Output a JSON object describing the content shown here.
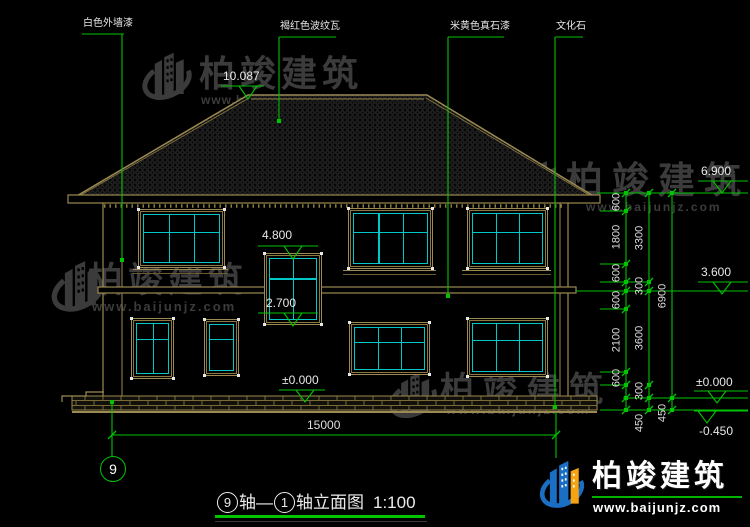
{
  "drawing_title": {
    "axis_start": "9",
    "mid": "轴—",
    "axis_end": "1",
    "suffix": "轴立面图",
    "scale": "1:100"
  },
  "axis_bubble_label": "9",
  "material_labels": [
    {
      "text": "白色外墙漆",
      "tx": 83,
      "ty": 19,
      "ux1": 82,
      "ux2": 124,
      "uy": 34,
      "lx": 122,
      "ly": 260
    },
    {
      "text": "褐红色波纹瓦",
      "tx": 280,
      "ty": 22,
      "ux1": 279,
      "ux2": 336,
      "uy": 37,
      "lx": 279,
      "ly": 121
    },
    {
      "text": "米黄色真石漆",
      "tx": 450,
      "ty": 22,
      "ux1": 448,
      "ux2": 504,
      "uy": 37,
      "lx": 448,
      "ly": 296
    },
    {
      "text": "文化石",
      "tx": 556,
      "ty": 22,
      "ux1": 555,
      "ux2": 583,
      "uy": 37,
      "lx": 555,
      "ly": 407
    }
  ],
  "levels": [
    {
      "value": "10.087",
      "tx": 223,
      "ty": 70,
      "ux1": 221,
      "ux2": 264,
      "uy": 86,
      "ax": 248,
      "ay": 99
    },
    {
      "value": "4.800",
      "tx": 262,
      "ty": 229,
      "ux1": 258,
      "ux2": 318,
      "uy": 246,
      "ax": 293,
      "ay": 259
    },
    {
      "value": "2.700",
      "tx": 266,
      "ty": 297,
      "ux1": 258,
      "ux2": 318,
      "uy": 313,
      "ax": 293,
      "ay": 326
    },
    {
      "value": "±0.000",
      "tx": 282,
      "ty": 374,
      "ux1": 279,
      "ux2": 325,
      "uy": 390,
      "ax": 305,
      "ay": 402
    },
    {
      "value": "6.900",
      "tx": 701,
      "ty": 165,
      "ux1": 698,
      "ux2": 748,
      "uy": 181,
      "ax": 722,
      "ay": 193
    },
    {
      "value": "3.600",
      "tx": 701,
      "ty": 266,
      "ux1": 698,
      "ux2": 748,
      "uy": 282,
      "ax": 722,
      "ay": 294
    },
    {
      "value": "±0.000",
      "tx": 696,
      "ty": 376,
      "ux1": 694,
      "ux2": 748,
      "uy": 391,
      "ax": 717,
      "ay": 403
    },
    {
      "value": "-0.450",
      "tx": 699,
      "ty": 425,
      "ux1": 694,
      "ux2": 748,
      "uy": 411,
      "ax": 707,
      "ay": 423
    }
  ],
  "ext_lines": [
    [
      597,
      748,
      193
    ],
    [
      600,
      626,
      211
    ],
    [
      600,
      626,
      264
    ],
    [
      600,
      649,
      282
    ],
    [
      576,
      748,
      291
    ],
    [
      600,
      626,
      309
    ],
    [
      600,
      626,
      372
    ],
    [
      600,
      626,
      385
    ],
    [
      623,
      748,
      398
    ],
    [
      600,
      748,
      410
    ]
  ],
  "dim_chains": [
    {
      "x": 626,
      "ticks": [
        193,
        211,
        264,
        282,
        291,
        309,
        372,
        385,
        398,
        410
      ],
      "labels": [
        {
          "v": "600",
          "y": 202
        },
        {
          "v": "1800",
          "y": 237
        },
        {
          "v": "600",
          "y": 273
        },
        {
          "v": "600",
          "y": 300
        },
        {
          "v": "2100",
          "y": 340
        },
        {
          "v": "600",
          "y": 378
        }
      ]
    },
    {
      "x": 649,
      "ticks": [
        193,
        282,
        291,
        385,
        398,
        410
      ],
      "labels": [
        {
          "v": "3300",
          "y": 238
        },
        {
          "v": "300",
          "y": 286
        },
        {
          "v": "3600",
          "y": 338
        },
        {
          "v": "300",
          "y": 391
        },
        {
          "v": "450",
          "y": 423
        }
      ]
    },
    {
      "x": 672,
      "ticks": [
        193,
        398,
        410
      ],
      "labels": [
        {
          "v": "6900",
          "y": 296
        },
        {
          "v": "450",
          "y": 413
        }
      ]
    }
  ],
  "dim_bottom": {
    "value": "15000",
    "y": 435,
    "x1": 112,
    "x2": 556,
    "tx": 307,
    "ty": 419
  },
  "windows": [
    {
      "x": 138,
      "y": 209,
      "w": 85,
      "h": 57,
      "cols": 3,
      "transom": 0.36,
      "sill": true
    },
    {
      "x": 264,
      "y": 253,
      "w": 56,
      "h": 70,
      "cols": 2,
      "transom": 0.32,
      "sill": false
    },
    {
      "x": 348,
      "y": 208,
      "w": 83,
      "h": 59,
      "cols": 3,
      "transom": 0.36,
      "sill": true
    },
    {
      "x": 467,
      "y": 208,
      "w": 79,
      "h": 59,
      "cols": 3,
      "transom": 0.36,
      "sill": true
    },
    {
      "x": 131,
      "y": 318,
      "w": 41,
      "h": 59,
      "cols": 2,
      "transom": 0.3,
      "sill": false
    },
    {
      "x": 204,
      "y": 319,
      "w": 33,
      "h": 55,
      "cols": 1,
      "transom": 0.3,
      "sill": false
    },
    {
      "x": 349,
      "y": 322,
      "w": 79,
      "h": 51,
      "cols": 3,
      "transom": 0.33,
      "sill": false
    },
    {
      "x": 467,
      "y": 318,
      "w": 79,
      "h": 57,
      "cols": 3,
      "transom": 0.33,
      "sill": false
    }
  ],
  "watermark_text": "柏竣建筑",
  "watermark_url": "www.baijunjz.com",
  "watermarks": [
    {
      "gx": 136,
      "gy": 46,
      "gw": 62,
      "gh": 58,
      "tx": 199,
      "ty": 56,
      "ts": 36,
      "tls": 5,
      "wx": 201,
      "wy": 94,
      "ws": 12,
      "wls": 1
    },
    {
      "gx": 30,
      "gy": 254,
      "gw": 96,
      "gh": 62,
      "tx": 88,
      "ty": 263,
      "ts": 35,
      "tls": 5,
      "wx": 92,
      "wy": 300,
      "ws": 13,
      "wls": 2
    },
    {
      "gx": 516,
      "gy": 155,
      "gw": 50,
      "gh": 52,
      "tx": 566,
      "ty": 162,
      "ts": 37,
      "tls": 9,
      "wx": 586,
      "wy": 201,
      "ws": 12,
      "wls": 2
    },
    {
      "gx": 386,
      "gy": 366,
      "gw": 54,
      "gh": 56,
      "tx": 440,
      "ty": 373,
      "ts": 34,
      "tls": 9,
      "wx": 446,
      "wy": 403,
      "ws": 13,
      "wls": 2
    }
  ],
  "footer_logo": {
    "name": "柏竣建筑",
    "url": "www.baijunjz.com"
  },
  "colors": {
    "background": "#000000",
    "building_line": "#9c8a52",
    "dimension_green": "#00c400",
    "window_cyan": "#00c8c8",
    "text_white": "#e8e8e8",
    "watermark_gray": "#3b3b3b",
    "logo_blue": "#1a6fc4",
    "logo_orange": "#f5a312"
  }
}
